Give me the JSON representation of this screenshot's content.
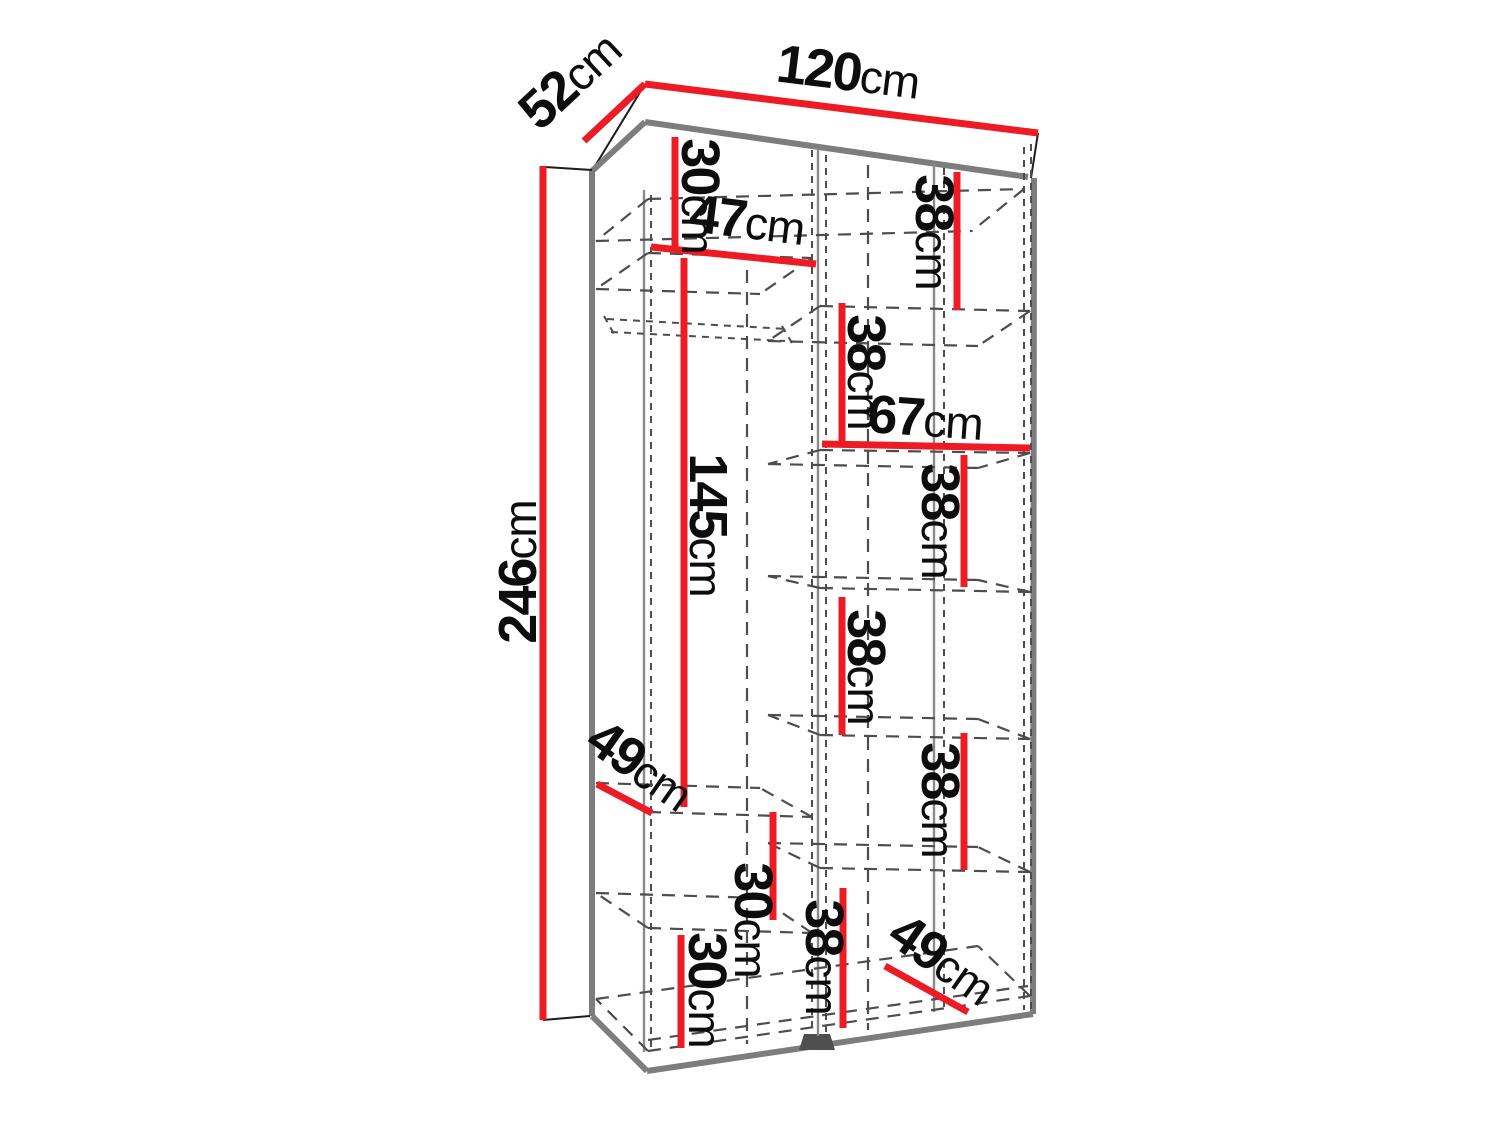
{
  "diagram": {
    "subject": "wardrobe-interior-dimensions",
    "unit": "cm",
    "overall": {
      "width": "120cm",
      "depth": "52cm",
      "height": "246cm"
    },
    "colors": {
      "dimension_line": "#ed1c24",
      "outline_gray": "#7d7d7d",
      "hidden_line": "#4d4d4d",
      "label_text": "#0d0d0d",
      "background": "#ffffff"
    },
    "labels": [
      {
        "id": "width-top",
        "value": "120",
        "unit": "cm",
        "x": 846,
        "y": 90,
        "rotate": 7
      },
      {
        "id": "depth-top",
        "value": "52",
        "unit": "cm",
        "x": 582,
        "y": 93,
        "rotate": -43
      },
      {
        "id": "height-left",
        "value": "246",
        "unit": "cm",
        "x": 536,
        "y": 572,
        "rotate": -90
      },
      {
        "id": "top-left-cubby-30",
        "value": "30",
        "unit": "cm",
        "x": 682,
        "y": 196,
        "rotate": 90
      },
      {
        "id": "left-section-width-47",
        "value": "47",
        "unit": "cm",
        "x": 745,
        "y": 238,
        "rotate": 7
      },
      {
        "id": "right-cubby-38-1",
        "value": "38",
        "unit": "cm",
        "x": 916,
        "y": 232,
        "rotate": 90
      },
      {
        "id": "right-cubby-38-2",
        "value": "38",
        "unit": "cm",
        "x": 848,
        "y": 372,
        "rotate": 90
      },
      {
        "id": "right-section-width-67",
        "value": "67",
        "unit": "cm",
        "x": 924,
        "y": 436,
        "rotate": 4
      },
      {
        "id": "right-cubby-38-3",
        "value": "38",
        "unit": "cm",
        "x": 922,
        "y": 521,
        "rotate": 90
      },
      {
        "id": "right-cubby-38-4",
        "value": "38",
        "unit": "cm",
        "x": 848,
        "y": 667,
        "rotate": 90
      },
      {
        "id": "right-cubby-38-5",
        "value": "38",
        "unit": "cm",
        "x": 922,
        "y": 800,
        "rotate": 90
      },
      {
        "id": "hanging-height-145",
        "value": "145",
        "unit": "cm",
        "x": 690,
        "y": 525,
        "rotate": 90
      },
      {
        "id": "shelf-depth-49-left",
        "value": "49",
        "unit": "cm",
        "x": 630,
        "y": 780,
        "rotate": 35
      },
      {
        "id": "left-cubby-30-mid",
        "value": "30",
        "unit": "cm",
        "x": 735,
        "y": 920,
        "rotate": 90
      },
      {
        "id": "left-cubby-30-bottom",
        "value": "30",
        "unit": "cm",
        "x": 689,
        "y": 990,
        "rotate": 90
      },
      {
        "id": "bottom-cubby-38",
        "value": "38",
        "unit": "cm",
        "x": 806,
        "y": 957,
        "rotate": 90
      },
      {
        "id": "shelf-depth-49-right",
        "value": "49",
        "unit": "cm",
        "x": 932,
        "y": 974,
        "rotate": 35
      }
    ]
  }
}
